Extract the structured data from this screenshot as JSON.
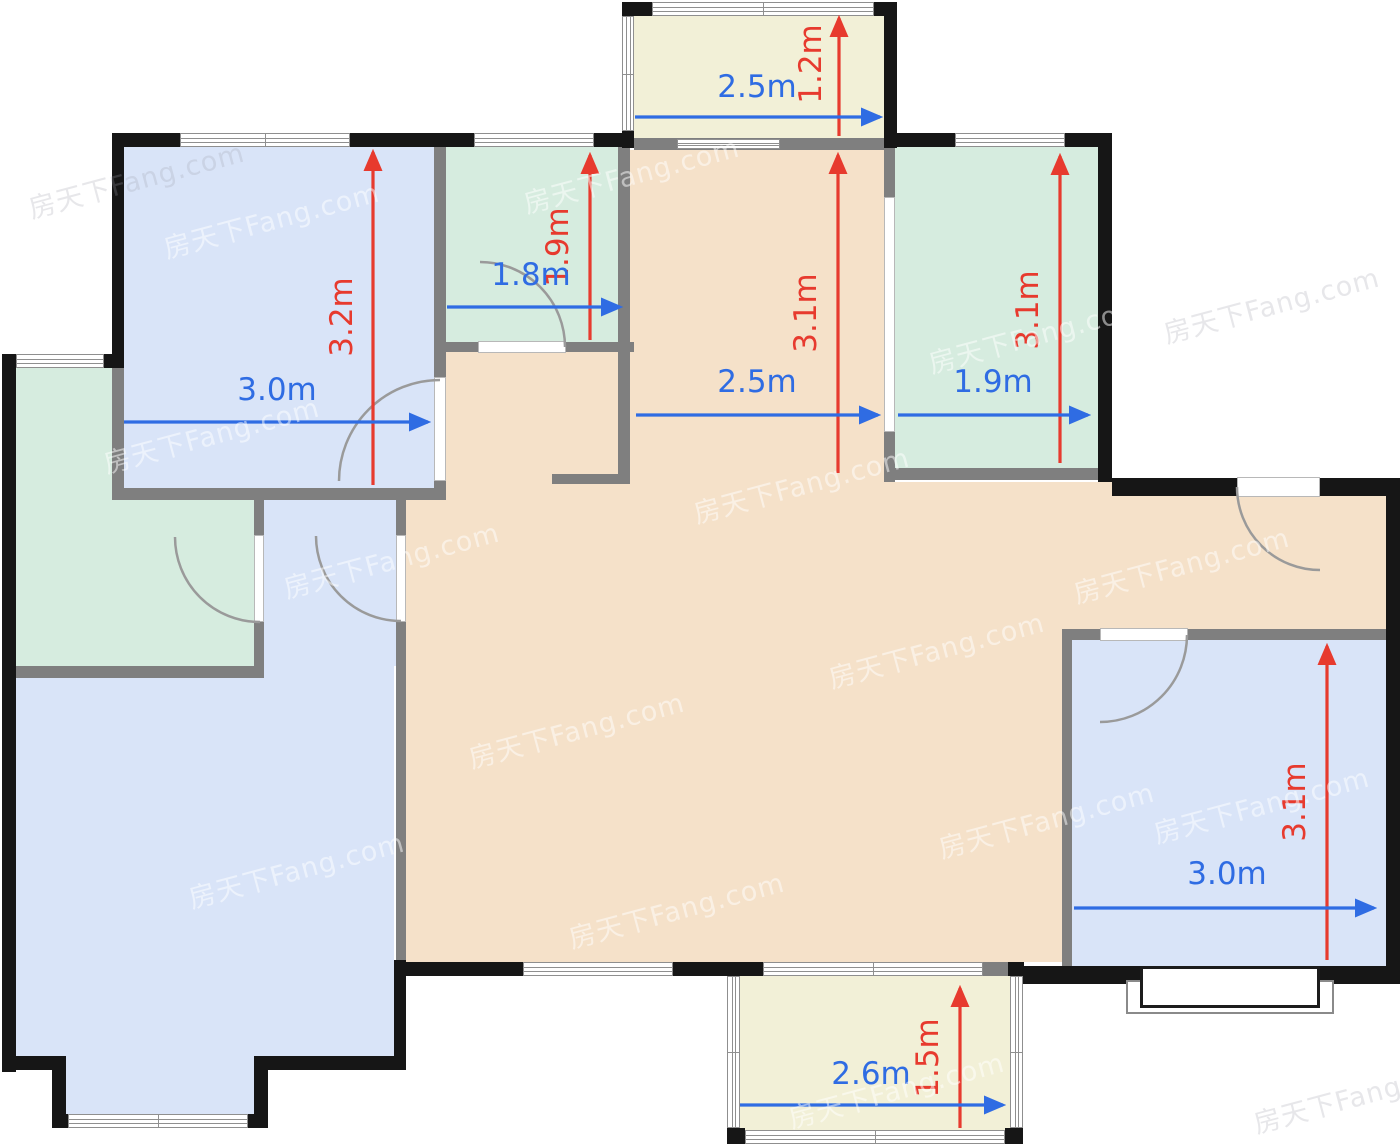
{
  "canvas": {
    "width": 1400,
    "height": 1148,
    "background": "#ffffff"
  },
  "palette": {
    "wall": "#161616",
    "inner_wall": "#7f7f7f",
    "blue_room": "#d9e4f8",
    "green_room": "#d6ecdf",
    "beige_area": "#f5e1c9",
    "yellow_balcony": "#f2f0d7",
    "dim_red": "#e73a2e",
    "dim_blue": "#2f6ce3",
    "arc": "#9a9a9a",
    "window_line": "#8f8f8f",
    "watermark_light": "rgba(255,255,255,0.5)",
    "watermark_gray": "rgba(160,160,172,0.25)"
  },
  "rooms": [
    {
      "name": "room-blue-top-left",
      "color": "blue_room",
      "rect": [
        124,
        147,
        310,
        341
      ]
    },
    {
      "name": "room-green-top-middle",
      "color": "green_room",
      "rect": [
        446,
        147,
        172,
        195
      ]
    },
    {
      "name": "balcony-top",
      "color": "yellow_balcony",
      "rect": [
        634,
        14,
        250,
        126
      ]
    },
    {
      "name": "hall-corridor",
      "color": "beige_area",
      "rect": [
        630,
        150,
        254,
        812
      ]
    },
    {
      "name": "hall-pocket-left",
      "color": "beige_area",
      "rect": [
        446,
        352,
        172,
        610
      ]
    },
    {
      "name": "hall-strip",
      "color": "beige_area",
      "rect": [
        618,
        484,
        12,
        478
      ]
    },
    {
      "name": "hall-west-strip",
      "color": "beige_area",
      "rect": [
        406,
        497,
        40,
        465
      ]
    },
    {
      "name": "hall-center",
      "color": "beige_area",
      "rect": [
        884,
        482,
        178,
        480
      ]
    },
    {
      "name": "entry-hall",
      "color": "beige_area",
      "rect": [
        1062,
        482,
        324,
        148
      ]
    },
    {
      "name": "room-green-top-right",
      "color": "green_room",
      "rect": [
        895,
        147,
        203,
        321
      ]
    },
    {
      "name": "room-green-left",
      "color": "green_room",
      "rect": [
        16,
        368,
        96,
        298
      ]
    },
    {
      "name": "room-green-left-lower",
      "color": "green_room",
      "rect": [
        16,
        500,
        238,
        166
      ]
    },
    {
      "name": "hallway-blue",
      "color": "blue_room",
      "rect": [
        264,
        500,
        132,
        166
      ]
    },
    {
      "name": "living-room-blue",
      "color": "blue_room",
      "rect": [
        16,
        666,
        378,
        390
      ]
    },
    {
      "name": "living-room-notch",
      "color": "blue_room",
      "rect": [
        66,
        1056,
        188,
        58
      ]
    },
    {
      "name": "room-blue-right",
      "color": "blue_room",
      "rect": [
        1072,
        640,
        314,
        326
      ]
    },
    {
      "name": "balcony-bottom",
      "color": "yellow_balcony",
      "rect": [
        740,
        976,
        270,
        154
      ]
    }
  ],
  "walls_gray": [
    [
      434,
      147,
      12,
      341
    ],
    [
      112,
      488,
      334,
      12
    ],
    [
      112,
      368,
      12,
      132
    ],
    [
      16,
      666,
      248,
      12
    ],
    [
      254,
      500,
      10,
      166
    ],
    [
      396,
      494,
      10,
      468
    ],
    [
      618,
      147,
      12,
      337
    ],
    [
      552,
      474,
      78,
      10
    ],
    [
      434,
      342,
      200,
      10
    ],
    [
      884,
      147,
      11,
      335
    ],
    [
      884,
      468,
      228,
      12
    ],
    [
      1062,
      629,
      338,
      11
    ],
    [
      1062,
      629,
      10,
      337
    ],
    [
      634,
      138,
      250,
      12
    ],
    [
      730,
      962,
      33,
      14
    ],
    [
      983,
      962,
      27,
      14
    ],
    [
      884,
      312,
      11,
      6
    ]
  ],
  "walls_black": [
    [
      112,
      133,
      68,
      14
    ],
    [
      350,
      133,
      96,
      14
    ],
    [
      112,
      133,
      12,
      235
    ],
    [
      100,
      354,
      24,
      14
    ],
    [
      2,
      354,
      14,
      718
    ],
    [
      446,
      133,
      28,
      14
    ],
    [
      594,
      133,
      40,
      14
    ],
    [
      622,
      131,
      12,
      17
    ],
    [
      622,
      2,
      30,
      14
    ],
    [
      874,
      2,
      23,
      14
    ],
    [
      884,
      2,
      13,
      146
    ],
    [
      893,
      133,
      62,
      14
    ],
    [
      1065,
      133,
      47,
      14
    ],
    [
      1098,
      133,
      14,
      349
    ],
    [
      1112,
      478,
      125,
      18
    ],
    [
      1320,
      478,
      80,
      18
    ],
    [
      1386,
      478,
      14,
      506
    ],
    [
      1320,
      966,
      80,
      18
    ],
    [
      1018,
      966,
      122,
      18
    ],
    [
      402,
      962,
      121,
      14
    ],
    [
      673,
      962,
      90,
      14
    ],
    [
      1008,
      962,
      16,
      14
    ],
    [
      727,
      1128,
      18,
      16
    ],
    [
      1005,
      1128,
      18,
      16
    ],
    [
      2,
      1056,
      62,
      14
    ],
    [
      52,
      1056,
      14,
      72
    ],
    [
      52,
      1114,
      16,
      14
    ],
    [
      248,
      1114,
      20,
      14
    ],
    [
      254,
      1056,
      14,
      72
    ],
    [
      268,
      1056,
      138,
      14
    ],
    [
      394,
      960,
      12,
      110
    ]
  ],
  "windows": [
    {
      "orient": "h",
      "rect": [
        180,
        133,
        170,
        14
      ]
    },
    {
      "orient": "h",
      "rect": [
        474,
        133,
        120,
        14
      ]
    },
    {
      "orient": "h",
      "rect": [
        955,
        133,
        110,
        14
      ]
    },
    {
      "orient": "h",
      "rect": [
        16,
        354,
        88,
        14
      ]
    },
    {
      "orient": "h",
      "rect": [
        652,
        2,
        222,
        14
      ]
    },
    {
      "orient": "v",
      "rect": [
        622,
        16,
        12,
        115
      ]
    },
    {
      "orient": "h",
      "rect": [
        677,
        139,
        103,
        10
      ]
    },
    {
      "orient": "h",
      "rect": [
        523,
        962,
        150,
        14
      ]
    },
    {
      "orient": "h",
      "rect": [
        763,
        962,
        220,
        14
      ]
    },
    {
      "orient": "v",
      "rect": [
        727,
        976,
        13,
        152
      ]
    },
    {
      "orient": "v",
      "rect": [
        1010,
        976,
        13,
        152
      ]
    },
    {
      "orient": "h",
      "rect": [
        745,
        1130,
        260,
        14
      ]
    },
    {
      "orient": "h",
      "rect": [
        68,
        1114,
        180,
        14
      ]
    }
  ],
  "jambs": [
    [
      434,
      377,
      12,
      104
    ],
    [
      478,
      341,
      88,
      12
    ],
    [
      254,
      535,
      10,
      87
    ],
    [
      396,
      535,
      10,
      87
    ],
    [
      884,
      197,
      11,
      235
    ],
    [
      1237,
      477,
      83,
      20
    ],
    [
      1100,
      628,
      88,
      13
    ]
  ],
  "door_arcs": [
    {
      "path": "M 339 481 A 101 101 0 0 1 440 380"
    },
    {
      "path": "M 480 262 A 85 85 0 0 1 565 347"
    },
    {
      "path": "M 175 537 A 85 85 0 0 0 260 622"
    },
    {
      "path": "M 316 536 A 85 85 0 0 0 401 621"
    },
    {
      "path": "M 1237 487 A 83 83 0 0 0 1320 570"
    },
    {
      "path": "M 1187 635 A 87 87 0 0 1 1100 722"
    }
  ],
  "bay_window": {
    "outer": [
      1126,
      980,
      208,
      34
    ],
    "inner": [
      1140,
      966,
      180,
      42
    ]
  },
  "dimensions": [
    {
      "label": "3.2m",
      "color": "red",
      "dir": "v",
      "pos": 373,
      "start": 485,
      "end": 152,
      "lx": 352,
      "ly": 317
    },
    {
      "label": "1.9m",
      "color": "red",
      "dir": "v",
      "pos": 590,
      "start": 340,
      "end": 155,
      "lx": 568,
      "ly": 247
    },
    {
      "label": "1.2m",
      "color": "red",
      "dir": "v",
      "pos": 839,
      "start": 136,
      "end": 18,
      "lx": 821,
      "ly": 64
    },
    {
      "label": "3.1m",
      "color": "red",
      "dir": "v",
      "pos": 838,
      "start": 473,
      "end": 155,
      "lx": 816,
      "ly": 313
    },
    {
      "label": "3.1m",
      "color": "red",
      "dir": "v",
      "pos": 1060,
      "start": 463,
      "end": 156,
      "lx": 1038,
      "ly": 310
    },
    {
      "label": "3.1m",
      "color": "red",
      "dir": "v",
      "pos": 1327,
      "start": 960,
      "end": 646,
      "lx": 1305,
      "ly": 802
    },
    {
      "label": "1.5m",
      "color": "red",
      "dir": "v",
      "pos": 960,
      "start": 1128,
      "end": 988,
      "lx": 938,
      "ly": 1058
    },
    {
      "label": "3.0m",
      "color": "blue",
      "dir": "h",
      "pos": 422,
      "start": 124,
      "end": 428,
      "lx": 277,
      "ly": 400
    },
    {
      "label": "1.8m",
      "color": "blue",
      "dir": "h",
      "pos": 307,
      "start": 447,
      "end": 620,
      "lx": 531,
      "ly": 285
    },
    {
      "label": "2.5m",
      "color": "blue",
      "dir": "h",
      "pos": 117,
      "start": 635,
      "end": 880,
      "lx": 757,
      "ly": 97
    },
    {
      "label": "2.5m",
      "color": "blue",
      "dir": "h",
      "pos": 415,
      "start": 636,
      "end": 878,
      "lx": 757,
      "ly": 392
    },
    {
      "label": "1.9m",
      "color": "blue",
      "dir": "h",
      "pos": 415,
      "start": 898,
      "end": 1088,
      "lx": 993,
      "ly": 392
    },
    {
      "label": "3.0m",
      "color": "blue",
      "dir": "h",
      "pos": 908,
      "start": 1074,
      "end": 1374,
      "lx": 1227,
      "ly": 884
    },
    {
      "label": "2.6m",
      "color": "blue",
      "dir": "h",
      "pos": 1105,
      "start": 740,
      "end": 1003,
      "lx": 871,
      "ly": 1084
    }
  ],
  "watermark": {
    "text": "房天下Fang.com",
    "instances": [
      {
        "x": 240,
        "y": 215,
        "tone": "light"
      },
      {
        "x": 600,
        "y": 170,
        "tone": "light"
      },
      {
        "x": 180,
        "y": 430,
        "tone": "light"
      },
      {
        "x": 360,
        "y": 555,
        "tone": "light"
      },
      {
        "x": 770,
        "y": 480,
        "tone": "light"
      },
      {
        "x": 1005,
        "y": 330,
        "tone": "light"
      },
      {
        "x": 545,
        "y": 725,
        "tone": "light"
      },
      {
        "x": 905,
        "y": 645,
        "tone": "light"
      },
      {
        "x": 265,
        "y": 865,
        "tone": "light"
      },
      {
        "x": 645,
        "y": 905,
        "tone": "light"
      },
      {
        "x": 1015,
        "y": 815,
        "tone": "light"
      },
      {
        "x": 475,
        "y": 1060,
        "tone": "light"
      },
      {
        "x": 865,
        "y": 1085,
        "tone": "light"
      },
      {
        "x": 1230,
        "y": 800,
        "tone": "light"
      },
      {
        "x": 1150,
        "y": 560,
        "tone": "light"
      },
      {
        "x": 1240,
        "y": 300,
        "tone": "gray"
      },
      {
        "x": 105,
        "y": 175,
        "tone": "gray"
      },
      {
        "x": 1330,
        "y": 1090,
        "tone": "gray"
      }
    ]
  }
}
